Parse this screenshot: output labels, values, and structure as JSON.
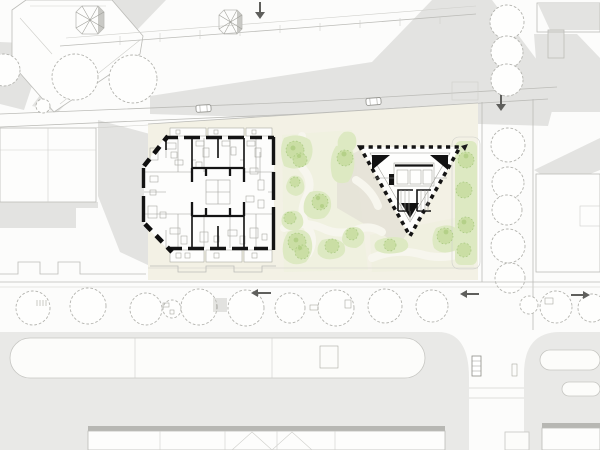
{
  "meta": {
    "kind": "architectural-site-plan",
    "canvas": {
      "width": 600,
      "height": 450
    },
    "description_visible_text": ""
  },
  "colors": {
    "background": "#fcfcfb",
    "shadow": "#e3e3e1",
    "shadow_warm": "#e4e1d6",
    "road": "#e9e9e7",
    "plaza": "#f3f1e5",
    "plaza_wash": "#edf0dc",
    "green_area": "#dde9c2",
    "green_canopy": "#c7dd9f",
    "wall_black": "#141414",
    "context_outline": "#bcbcb8",
    "arrow_dark": "#5f5f5c",
    "tower_side": "#c9c9c5"
  },
  "elements": {
    "left_building": "apartment-floorplan",
    "right_building": "triangle-tower-plan",
    "park": "plaza-with-green-patches",
    "streets": "tree-lined-streets",
    "context": "surrounding-blocks-and-roads"
  }
}
